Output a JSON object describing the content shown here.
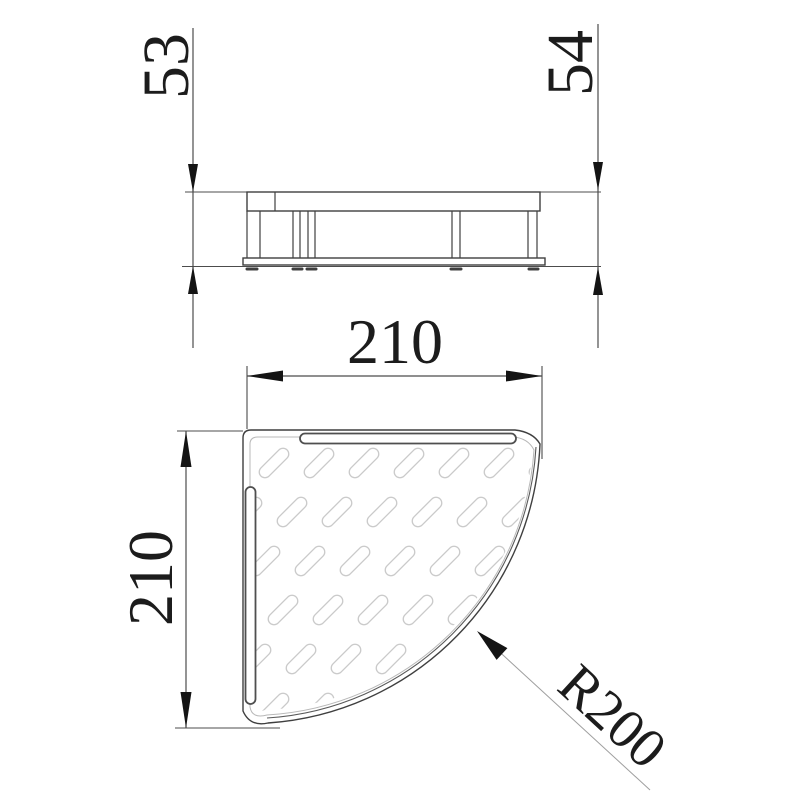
{
  "drawing": {
    "kind": "technical-drawing-corner-shelf",
    "dims": {
      "side_left": "53",
      "side_right": "54",
      "plan_width": "210",
      "plan_depth": "210",
      "radius": "R200"
    },
    "colors": {
      "background": "#ffffff",
      "ink": "#1c1c1c",
      "line": "#3f3f3f",
      "mid": "#5a5a5a",
      "rim": "#b8b8b8",
      "dim": "#4c4c4c",
      "arrow": "#141414",
      "slot": "#4f4f4f",
      "leader": "#9f9f9f",
      "pattern": "#cacaca"
    },
    "pattern": {
      "start_x": 319,
      "start_y": 463,
      "x_pitch": 45,
      "y_pitch": 49,
      "row_x_offset": 18,
      "rows": 6,
      "cols_from": -3,
      "cols_to": 5,
      "slot_length": 37,
      "slot_width": 11.5,
      "angle_deg": -45
    }
  }
}
